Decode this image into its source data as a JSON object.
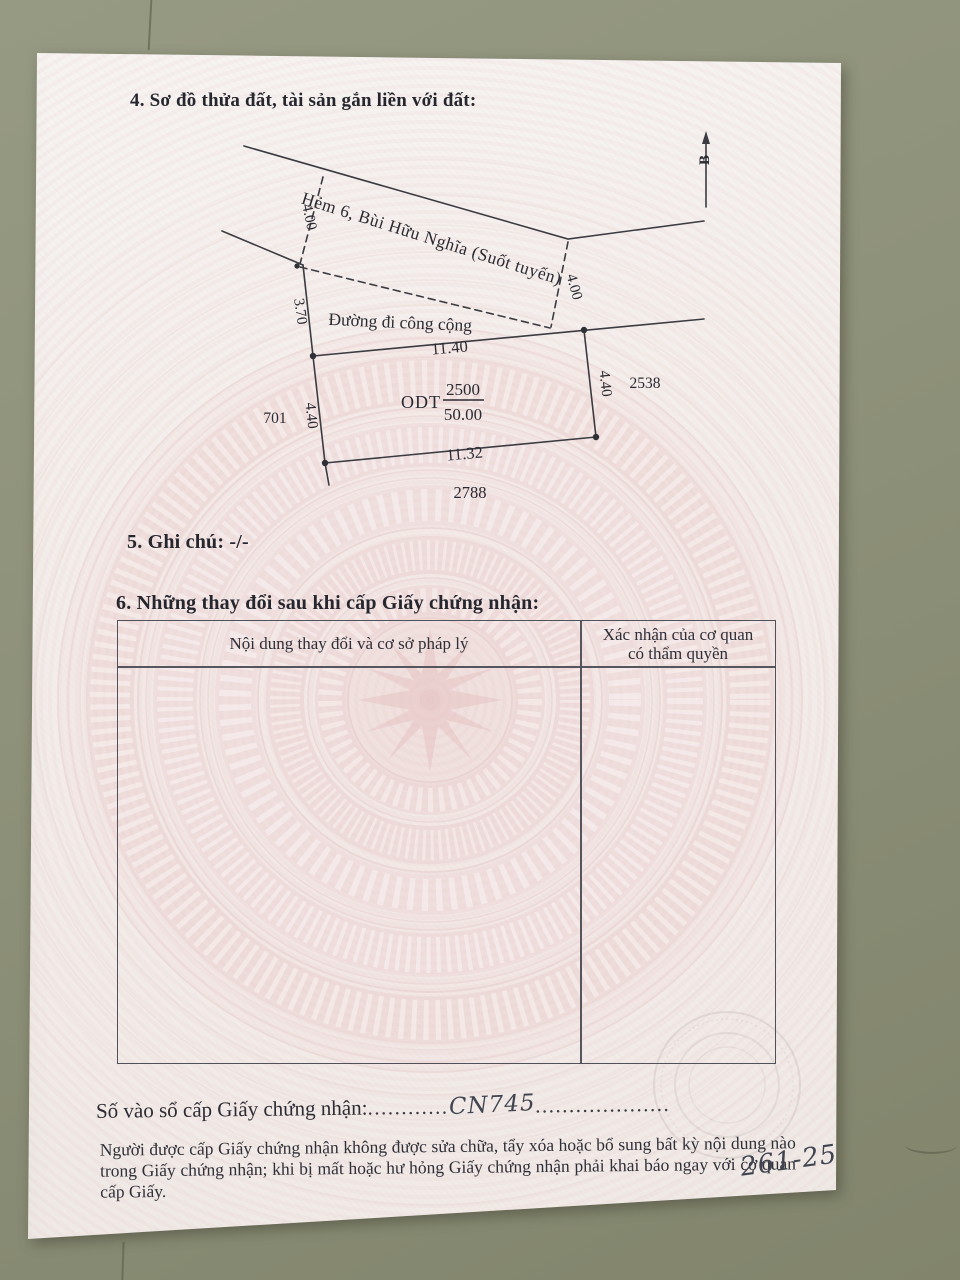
{
  "photo": {
    "surface_color": "#8e9179",
    "paper_color": "#f3eeeb",
    "watermark_pink": "#e6c6c4",
    "ink_color": "#2b2b31"
  },
  "section4": {
    "title": "4. Sơ đồ thửa đất, tài sản gắn liền với đất:"
  },
  "diagram": {
    "north_label": "B",
    "road_name": "Hẻm 6, Bùi Hữu Nghĩa (Suốt tuyến)",
    "path_label": "Đường đi công cộng",
    "dims": {
      "alley_width_left": "4.00",
      "alley_width_right": "4.00",
      "left_upper": "3.70",
      "top": "11.40",
      "bottom": "11.32",
      "left": "4.40",
      "right": "4.40"
    },
    "parcel": {
      "land_use": "ODT",
      "parcel_number": "2500",
      "area": "50.00"
    },
    "neighbors": {
      "left": "701",
      "right": "2538",
      "bottom": "2788"
    }
  },
  "section5": {
    "title": "5. Ghi chú: -/-"
  },
  "section6": {
    "title": "6. Những thay đổi sau khi cấp Giấy chứng nhận:",
    "table": {
      "col1_header": "Nội dung thay đổi và cơ sở pháp lý",
      "col2_header_line1": "Xác nhận của cơ quan",
      "col2_header_line2": "có thẩm quyền"
    }
  },
  "footer": {
    "serial_label": "Số vào sổ cấp Giấy chứng nhận:",
    "dots_before": "............",
    "serial_value": "CN745",
    "dots_after": "....................",
    "note_line1": "Người được cấp Giấy chứng nhận không được sửa chữa, tẩy xóa hoặc bổ sung bất kỳ nội dung nào trong",
    "note_line2": "Giấy chứng nhận; khi bị mất hoặc hư hỏng Giấy chứng nhận phải khai báo ngay với cơ quan cấp Giấy.",
    "handwritten_number": "261-25"
  }
}
